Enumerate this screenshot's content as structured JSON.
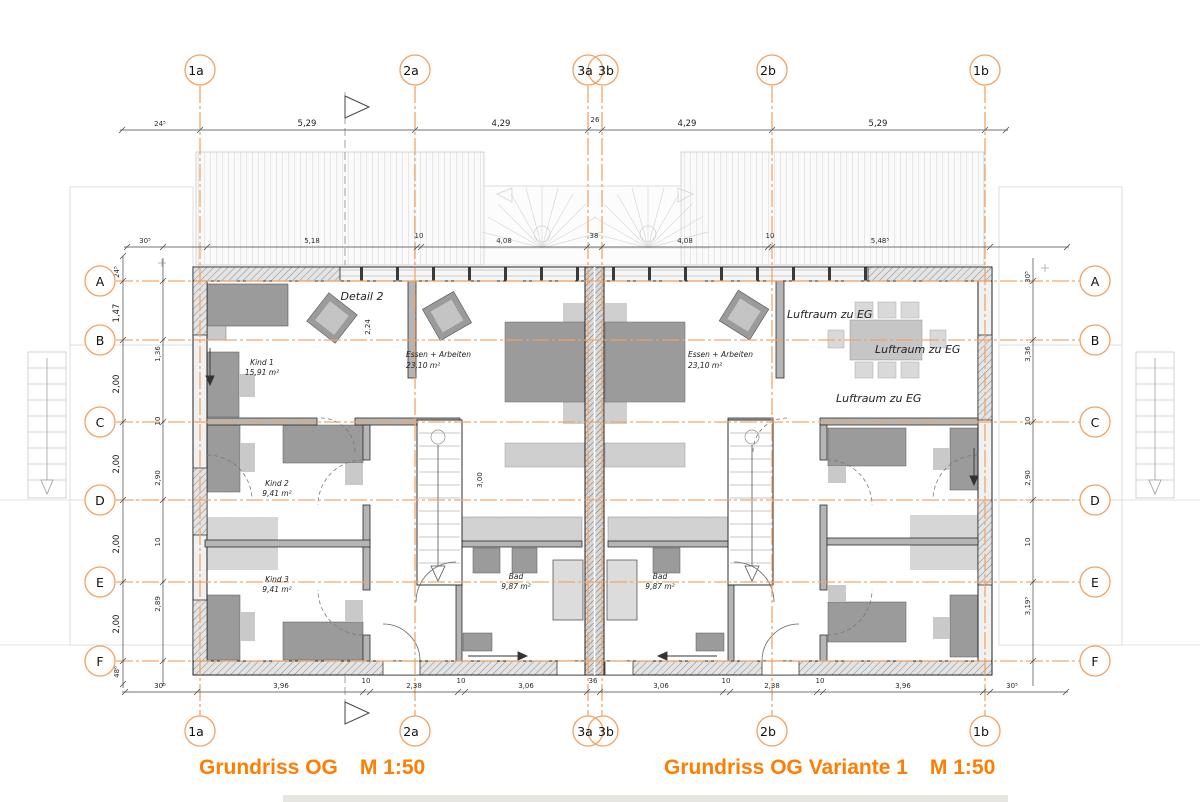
{
  "colors": {
    "axis_orange": "#F2A262",
    "title_orange": "#FF7D00"
  },
  "titles": {
    "left_name": "Grundriss OG",
    "left_scale": "M 1:50",
    "right_name": "Grundriss OG Variante 1",
    "right_scale": "M 1:50"
  },
  "axes": {
    "cols": [
      "1a",
      "2a",
      "3a",
      "3b",
      "2b",
      "1b"
    ],
    "rows": [
      "A",
      "B",
      "C",
      "D",
      "E",
      "F"
    ]
  },
  "dims": {
    "top": [
      "24⁵",
      "5,29",
      "4,29",
      "26",
      "4,29",
      "5,29"
    ],
    "mid": [
      "30⁵",
      "5,18",
      "10",
      "4,08",
      "38",
      "4,08",
      "10",
      "5,48⁵"
    ],
    "bottom": [
      "30⁵",
      "3,96",
      "10",
      "2,38",
      "10",
      "3,06",
      "36",
      "3,06",
      "10",
      "2,38",
      "10",
      "3,96",
      "30⁵"
    ],
    "left_outer": [
      "24⁵",
      "1,47",
      "2,00",
      "2,00",
      "2,00",
      "2,00",
      "48⁶"
    ],
    "left_inner": [
      "1,36",
      "10",
      "2,90",
      "10",
      "2,89"
    ],
    "right_inner": [
      "30⁵",
      "3,36",
      "10",
      "2,90",
      "10",
      "3,19⁵"
    ],
    "stair": "3,00",
    "detail_h": "2,24"
  },
  "rooms": {
    "detail_note": "Detail 2",
    "kind1": "Kind 1",
    "kind1_area": "15,91 m²",
    "essen": "Essen + Arbeiten",
    "essen_area": "23,10 m²",
    "kind2": "Kind 2",
    "kind2_area": "9,41 m²",
    "kind3": "Kind 3",
    "kind3_area": "9,41 m²",
    "bad": "Bad",
    "bad_area": "9,87 m²",
    "luftraum": "Luftraum zu EG"
  }
}
